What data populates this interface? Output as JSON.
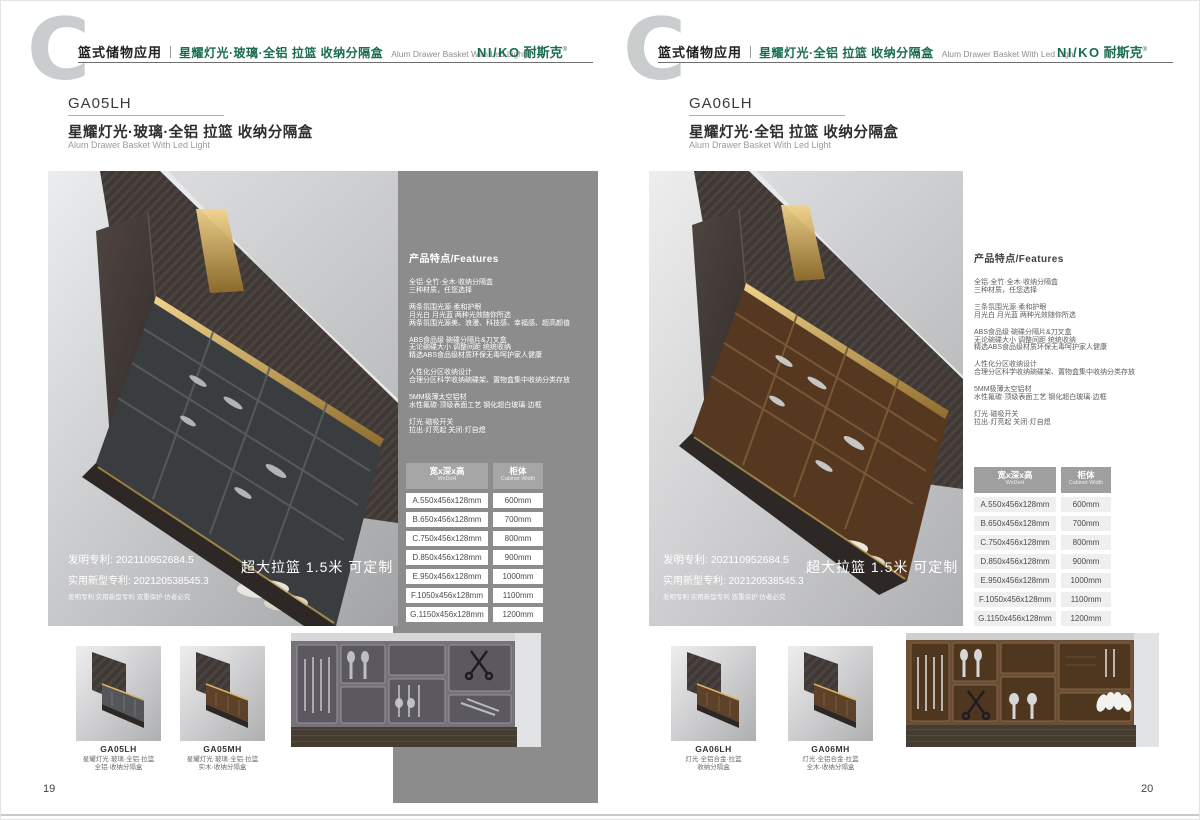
{
  "shared": {
    "watermark": "C",
    "features_title": "产品特点/Features",
    "patent_line1": "发明专利: 202110952684.5",
    "patent_line2": "实用新型专利: 202120538545.3",
    "patent_line3": "发明专利 实用新型专利 双重保护 仿者必究",
    "banner": "超大拉篮 1.5米 可定制",
    "table": {
      "col1_cn": "宽x深x高",
      "col1_en": "WxDxH",
      "col2_cn": "柜体",
      "col2_en": "Cabinet Width",
      "rows": [
        {
          "size": "A.550x456x128mm",
          "cab": "600mm"
        },
        {
          "size": "B.650x456x128mm",
          "cab": "700mm"
        },
        {
          "size": "C.750x456x128mm",
          "cab": "800mm"
        },
        {
          "size": "D.850x456x128mm",
          "cab": "900mm"
        },
        {
          "size": "E.950x456x128mm",
          "cab": "1000mm"
        },
        {
          "size": "F.1050x456x128mm",
          "cab": "1100mm"
        },
        {
          "size": "G.1150x456x128mm",
          "cab": "1200mm"
        }
      ]
    }
  },
  "brand": {
    "logo_latin": "NI/KO",
    "logo_cn": "耐斯克",
    "reg_mark": "®",
    "green": "#1a6b52",
    "panel_gray": "#8c8c8c",
    "led_gold": "#d8b36a"
  },
  "left": {
    "page_number": "19",
    "header_category": "篮式储物应用",
    "header_title": "星耀灯光·玻璃·全铝 拉篮 收纳分隔盒",
    "header_en": "Alum Drawer Basket With Led Light",
    "code": "GA05LH",
    "name_cn": "星耀灯光·玻璃·全铝 拉篮 收纳分隔盒",
    "name_en": "Alum Drawer Basket With Led Light",
    "features": [
      {
        "lines": [
          "全铝·全竹·全木·收纳分隔盒",
          "三种材质，任您选择"
        ]
      },
      {
        "lines": [
          "两条氛围光源·柔和护眼",
          "月光白 月光蓝 两种光效随你所选",
          "两条氛围光源美、浪漫、科技感、幸福感、超高颜值"
        ]
      },
      {
        "lines": [
          "ABS食品级 碗碟分隔片&刀叉盒",
          "无论碗碟大小 调整间距 统统收纳",
          "精选ABS食品级材质环保无毒呵护家人健康"
        ]
      },
      {
        "lines": [
          "人性化分区收纳设计",
          "合理分区科学收纳碗碟架、置物盒集中收纳分类存放"
        ]
      },
      {
        "lines": [
          "5MM极薄太空铝材",
          "水性氟碳·顶级表面工艺 钢化超白玻璃·边框"
        ]
      },
      {
        "lines": [
          "灯光·磁吸开关",
          "拉出·灯亮起 关闭·灯自熄"
        ]
      }
    ],
    "thumbs": [
      {
        "code": "GA05LH",
        "line1": "星耀灯光·玻璃·全铝·拉篮",
        "line2": "全铝·收纳分隔盒"
      },
      {
        "code": "GA05MH",
        "line1": "星耀灯光·玻璃·全铝·拉篮",
        "line2": "实木·收纳分隔盒"
      }
    ]
  },
  "right": {
    "page_number": "20",
    "header_category": "篮式储物应用",
    "header_title": "星耀灯光·全铝 拉篮 收纳分隔盒",
    "header_en": "Alum Drawer Basket With Led Light",
    "code": "GA06LH",
    "name_cn": "星耀灯光·全铝 拉篮 收纳分隔盒",
    "name_en": "Alum Drawer Basket With Led Light",
    "features": [
      {
        "lines": [
          "全铝·全竹·全木·收纳分隔盒",
          "三种材质，任您选择"
        ]
      },
      {
        "lines": [
          "三条氛围光源·柔和护眼",
          "月光白 月光蓝 两种光效随你所选"
        ]
      },
      {
        "lines": [
          "ABS食品级 碗碟分隔片&刀叉盒",
          "无论碗碟大小 调整间距 统统收纳",
          "精选ABS食品级材质环保无毒呵护家人健康"
        ]
      },
      {
        "lines": [
          "人性化分区收纳设计",
          "合理分区科学收纳碗碟架、置物盒集中收纳分类存放"
        ]
      },
      {
        "lines": [
          "5MM极薄太空铝材",
          "水性氟碳·顶级表面工艺 钢化超白玻璃·边框"
        ]
      },
      {
        "lines": [
          "灯光·磁吸开关",
          "拉出·灯亮起 关闭·灯自熄"
        ]
      }
    ],
    "thumbs": [
      {
        "code": "GA06LH",
        "line1": "灯光·全铝合金·拉篮",
        "line2": "收纳分隔盒"
      },
      {
        "code": "GA06MH",
        "line1": "灯光·全铝合金·拉篮",
        "line2": "全木·收纳分隔盒"
      }
    ]
  }
}
